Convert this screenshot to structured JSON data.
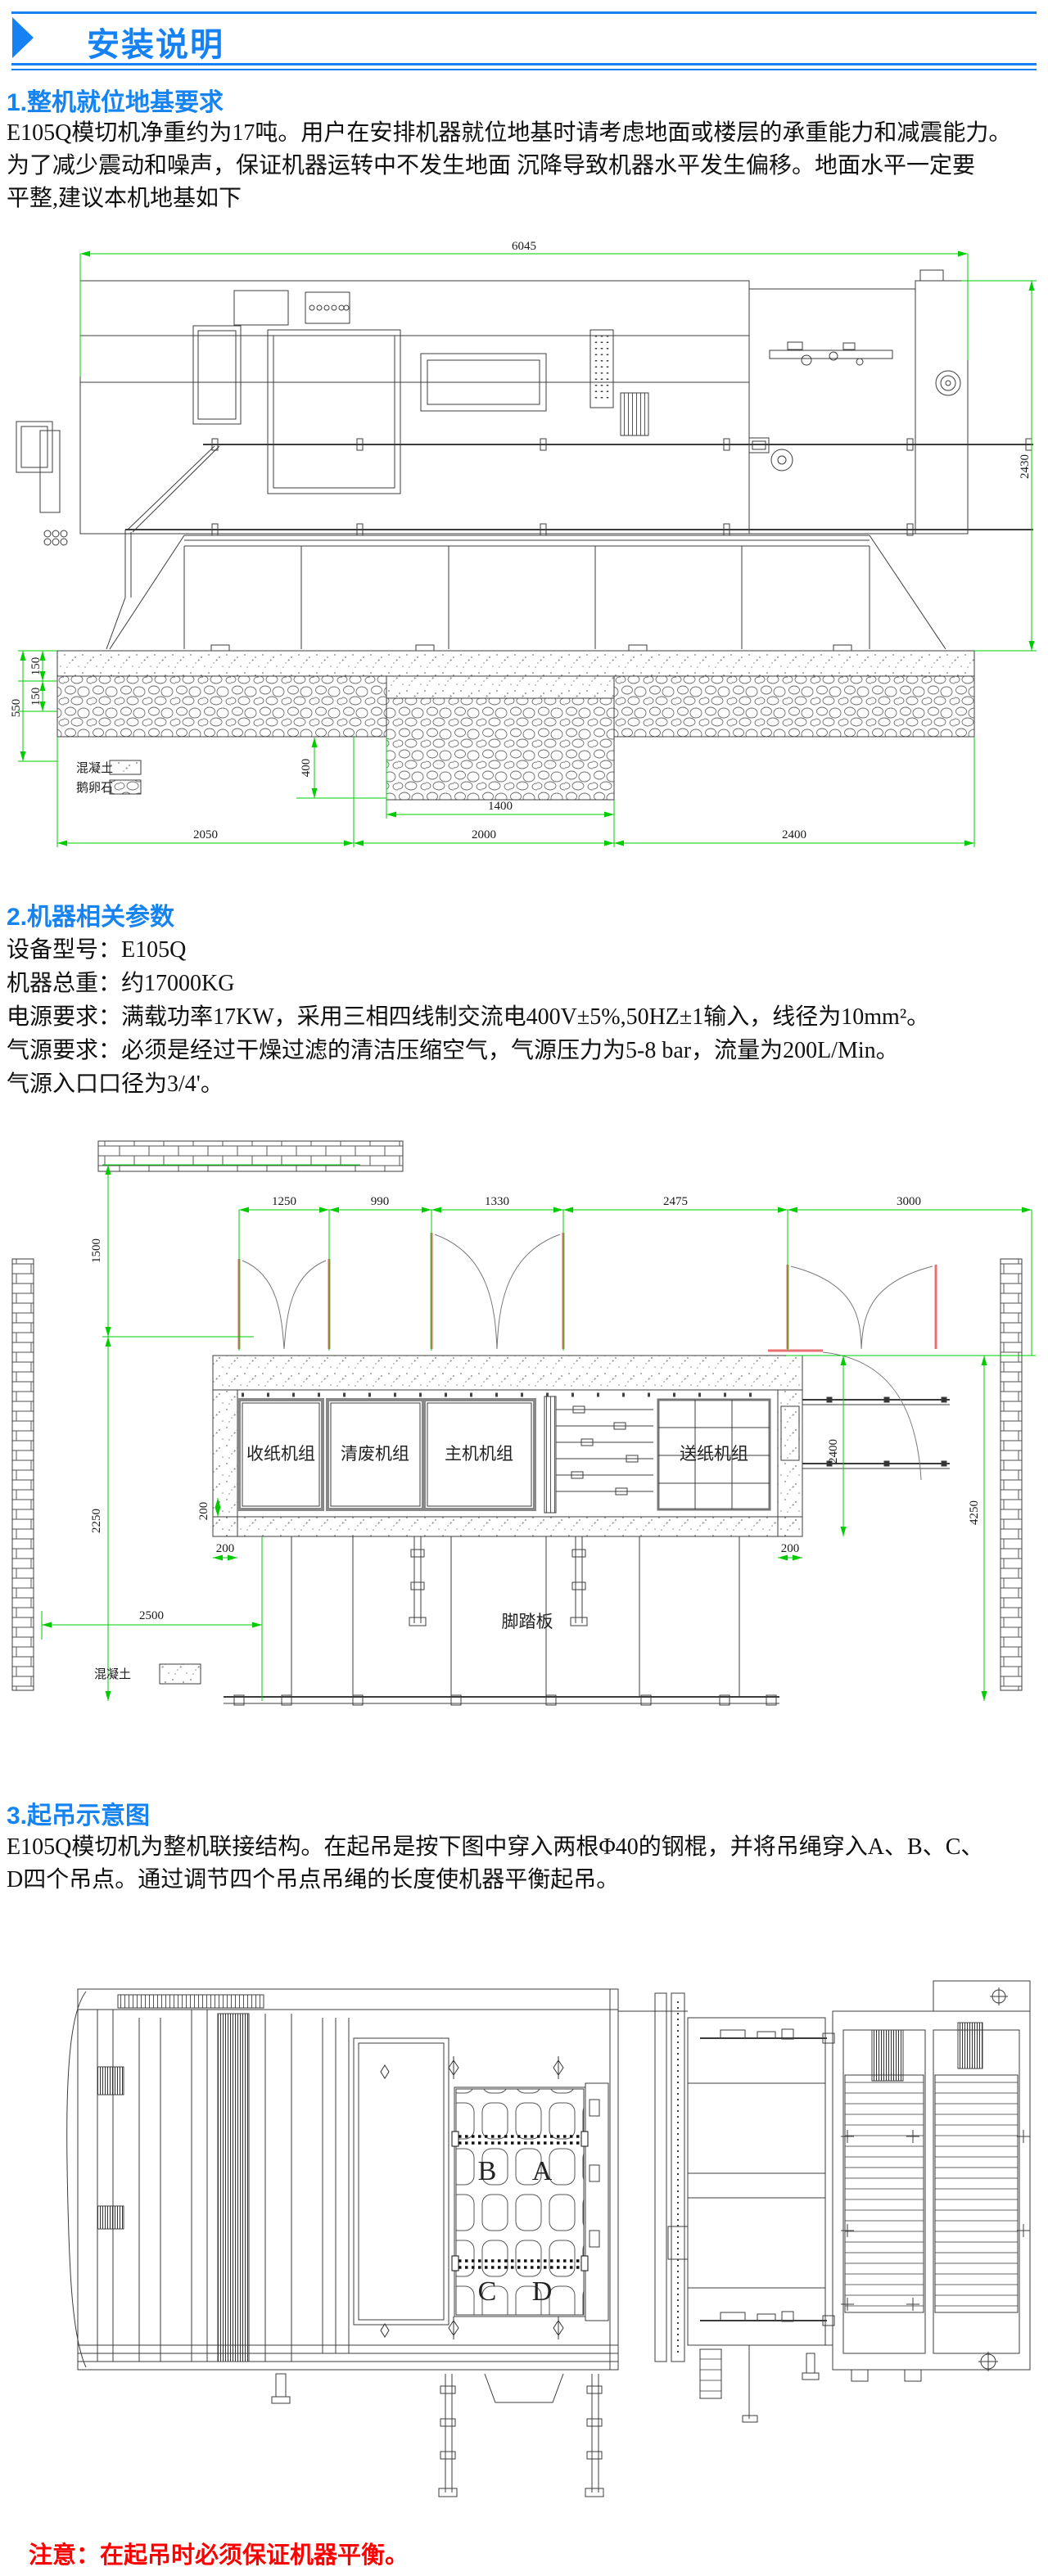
{
  "header": {
    "title": "安装说明"
  },
  "sections": {
    "s1": {
      "title": "1.整机就位地基要求",
      "body": [
        "E105Q模切机净重约为17吨。用户在安排机器就位地基时请考虑地面或楼层的承重能力和减震能力。",
        "为了减少震动和噪声，保证机器运转中不发生地面 沉降导致机器水平发生偏移。地面水平一定要",
        "平整,建议本机地基如下"
      ]
    },
    "s2": {
      "title": "2.机器相关参数",
      "lines": [
        "设备型号：E105Q",
        "机器总重：约17000KG",
        "电源要求：满载功率17KW，采用三相四线制交流电400V±5%,50HZ±1输入，线径为10mm²。",
        "气源要求：必须是经过干燥过滤的清洁压缩空气，气源压力为5-8 bar，流量为200L/Min。",
        "气源入口口径为3/4'。"
      ]
    },
    "s3": {
      "title": "3.起吊示意图",
      "body": [
        "E105Q模切机为整机联接结构。在起吊是按下图中穿入两根Φ40的钢棍，并将吊绳穿入A、B、C、",
        "D四个吊点。通过调节四个吊点吊绳的长度使机器平衡起吊。"
      ]
    }
  },
  "drawing1": {
    "dim_width": "6045",
    "dim_height": "2430",
    "dim_550": "550",
    "dim_150a": "150",
    "dim_150b": "150",
    "dim_400": "400",
    "dim_1400": "1400",
    "dim_2050": "2050",
    "dim_2000": "2000",
    "dim_2400": "2400",
    "legend_concrete": "混凝土",
    "legend_cobble": "鹅卵石"
  },
  "drawing2": {
    "dim_1250": "1250",
    "dim_990": "990",
    "dim_1330": "1330",
    "dim_2475": "2475",
    "dim_3000": "3000",
    "dim_1500": "1500",
    "dim_2250": "2250",
    "dim_2400": "2400",
    "dim_4250": "4250",
    "dim_200_left_v": "200",
    "dim_200_left_h": "200",
    "dim_200_right": "200",
    "dim_2500": "2500",
    "unit_delivery": "收纸机组",
    "unit_stripping": "清废机组",
    "unit_main": "主机机组",
    "unit_feeder": "送纸机组",
    "footboard": "脚踏板",
    "legend_concrete": "混凝土"
  },
  "drawing3": {
    "point_a": "A",
    "point_b": "B",
    "point_c": "C",
    "point_d": "D"
  },
  "note": "注意：在起吊时必须保证机器平衡。",
  "colors": {
    "accent": "#1581f2",
    "dim_green": "#00cc00",
    "warn_red": "#fe0000"
  }
}
